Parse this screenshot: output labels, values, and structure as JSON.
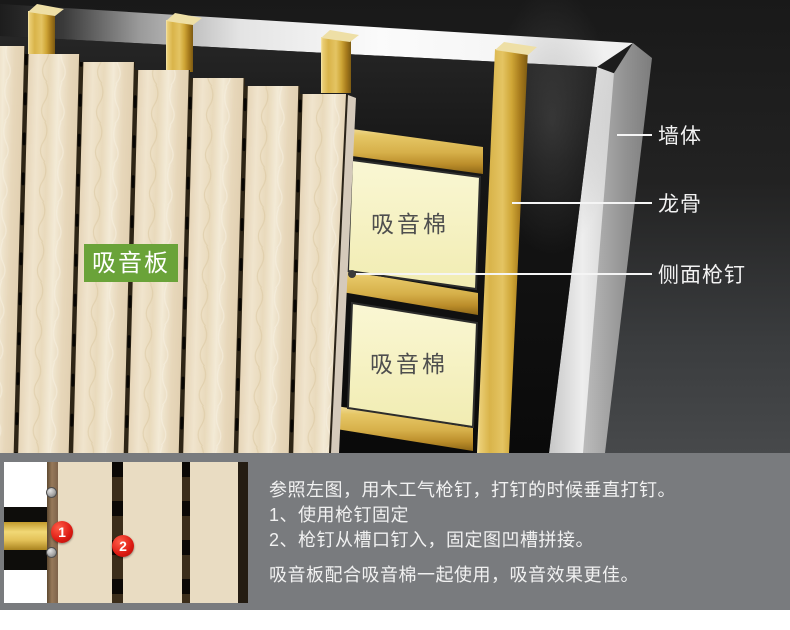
{
  "diagram": {
    "panel_label": "吸音板",
    "cotton_label_1": "吸音棉",
    "cotton_label_2": "吸音棉",
    "wall_label": "墙体",
    "keel_label": "龙骨",
    "side_nail_label": "侧面枪钉",
    "colors": {
      "panel_tag_green": "#6aa339",
      "cotton_yellow": "#f8f4c8",
      "keel_gold": "#ddb953",
      "wall_gray": "#9a9a9a",
      "insulation_black": "#141414"
    }
  },
  "instructions": {
    "intro": "参照左图，用木工气枪钉，打钉的时候垂直打钉。",
    "step_1": "1、使用枪钉固定",
    "step_2": "2、枪钉从槽口钉入，固定图凹槽拼接。",
    "note": "吸音板配合吸音棉一起使用，吸音效果更佳。",
    "badge_1": "1",
    "badge_2": "2"
  }
}
